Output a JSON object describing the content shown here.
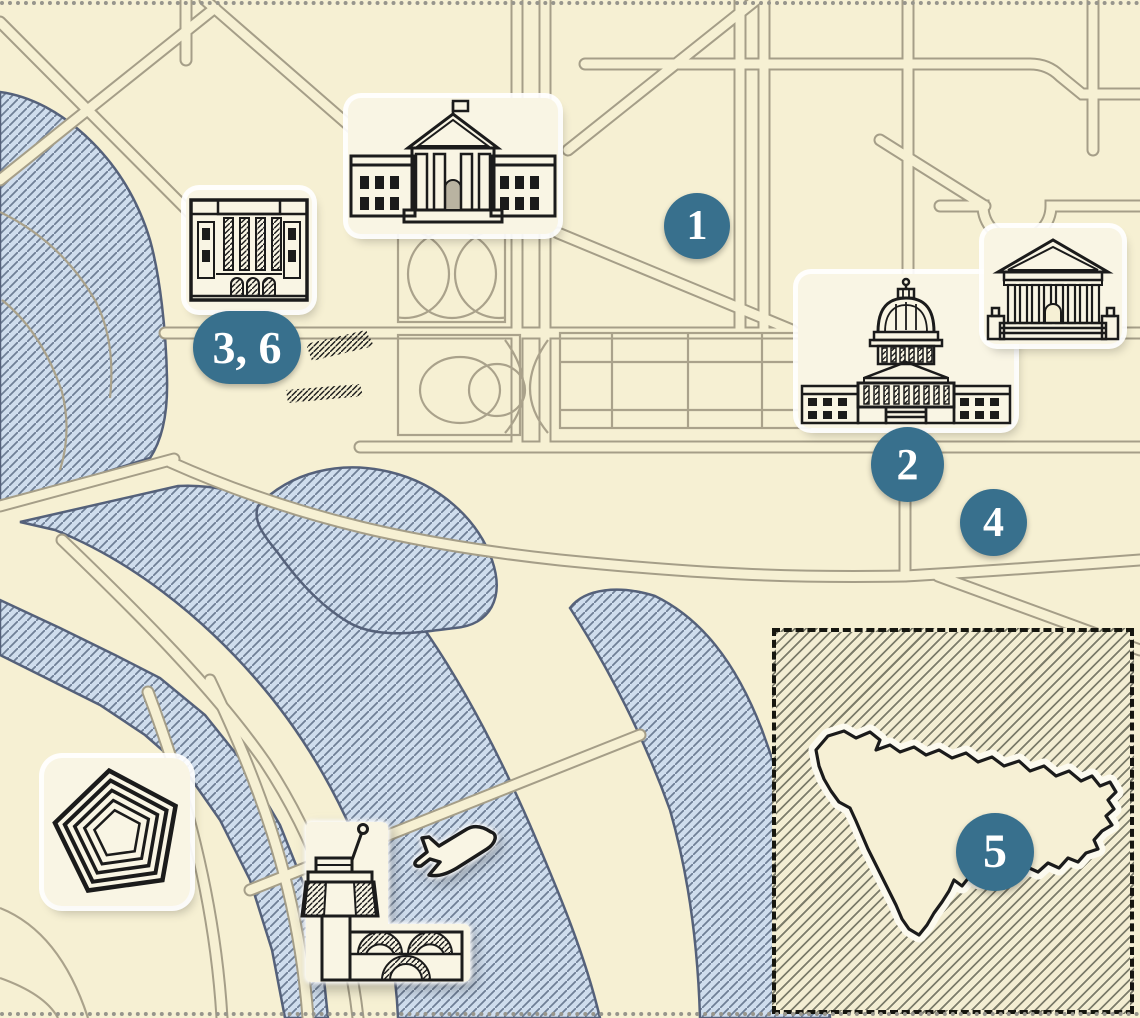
{
  "map": {
    "type": "illustrated-city-map",
    "markers": [
      {
        "id": "1",
        "label": "1"
      },
      {
        "id": "2",
        "label": "2"
      },
      {
        "id": "3-6",
        "label": "3, 6"
      },
      {
        "id": "4",
        "label": "4"
      },
      {
        "id": "5",
        "label": "5"
      }
    ],
    "icons": [
      "white-house-icon",
      "government-building-icon",
      "capitol-icon",
      "courthouse-icon",
      "pentagon-icon",
      "airport-control-tower-icon",
      "airplane-icon",
      "country-outline-icon"
    ],
    "colors": {
      "background": "#f6f0d3",
      "road_casing": "#a59e88",
      "water_fill": "#cfdded",
      "water_hatch": "#6f7f96",
      "water_outline": "#55617a",
      "marker_fill": "#38708d",
      "marker_text": "#ffffff",
      "line_art": "#1b1b1b",
      "inset_border": "#16160f"
    }
  }
}
